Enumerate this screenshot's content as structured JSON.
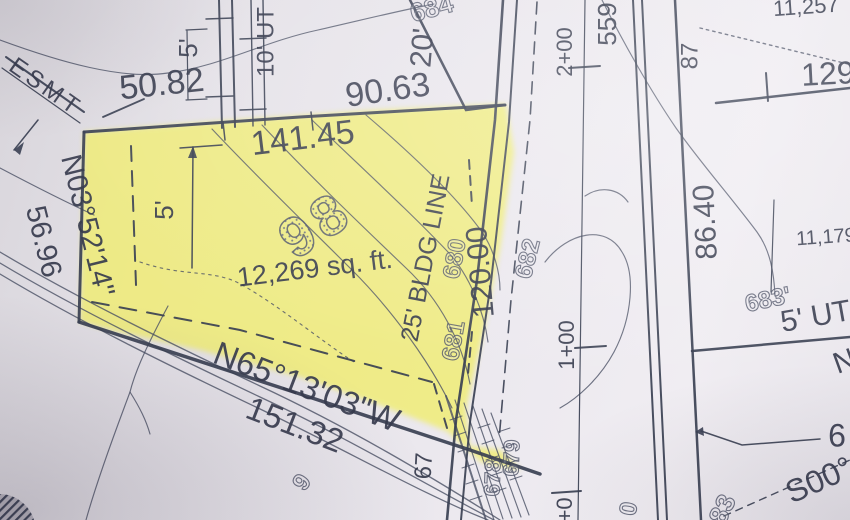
{
  "map": {
    "type": "subdivision-plat-survey-photo",
    "highlighted_lot": {
      "number": "98",
      "area": "12,269 sq. ft."
    },
    "colors": {
      "paper": "#e8e5ea",
      "ink": "#3a4053",
      "highlight": "#f0ed6e"
    },
    "labels": [
      {
        "name": "esmt-label",
        "text": "ESMT",
        "x": 45,
        "y": 88,
        "rot": 35,
        "size": 24,
        "ls": 4
      },
      {
        "name": "dim-50-82",
        "text": "50.82",
        "x": 162,
        "y": 86,
        "rot": -6,
        "size": 34
      },
      {
        "name": "easement-5ft-top",
        "text": "5'",
        "x": 190,
        "y": 48,
        "rot": -90,
        "size": 26
      },
      {
        "name": "easement-10ft-ut",
        "text": "10' UT",
        "x": 267,
        "y": 42,
        "rot": -90,
        "size": 24
      },
      {
        "name": "dim-90-63",
        "text": "90.63",
        "x": 388,
        "y": 92,
        "rot": -8,
        "size": 34
      },
      {
        "name": "easement-20ft",
        "text": "20'",
        "x": 424,
        "y": 48,
        "rot": -85,
        "size": 30
      },
      {
        "name": "contour-684",
        "text": "684",
        "x": 432,
        "y": 10,
        "rot": -15,
        "size": 26,
        "style": "outline"
      },
      {
        "name": "station-2-00",
        "text": "2+00",
        "x": 566,
        "y": 52,
        "rot": -90,
        "size": 22
      },
      {
        "name": "dim-559",
        "text": "559",
        "x": 609,
        "y": 24,
        "rot": -90,
        "size": 26
      },
      {
        "name": "dim-87",
        "text": "87",
        "x": 691,
        "y": 56,
        "rot": -90,
        "size": 24
      },
      {
        "name": "lot-area-11257",
        "text": "11,257",
        "x": 806,
        "y": 8,
        "rot": -4,
        "size": 22
      },
      {
        "name": "dim-129",
        "text": "129",
        "x": 828,
        "y": 76,
        "rot": -3,
        "size": 32
      },
      {
        "name": "dim-86-40",
        "text": "86.40",
        "x": 707,
        "y": 222,
        "rot": -93,
        "size": 30
      },
      {
        "name": "lot-area-11179",
        "text": "11,179",
        "x": 826,
        "y": 238,
        "rot": -4,
        "size": 20
      },
      {
        "name": "contour-683",
        "text": "683'",
        "x": 768,
        "y": 301,
        "rot": -12,
        "size": 24,
        "style": "outline"
      },
      {
        "name": "easement-5ft-ut",
        "text": "5' UT",
        "x": 816,
        "y": 318,
        "rot": -10,
        "size": 30
      },
      {
        "name": "bearing-n03-52-14",
        "text": "N03°52'14\"",
        "x": 86,
        "y": 226,
        "rot": 76,
        "size": 29
      },
      {
        "name": "dim-56-96",
        "text": "56.96",
        "x": 42,
        "y": 242,
        "rot": 76,
        "size": 29
      },
      {
        "name": "dim-141-45",
        "text": "141.45",
        "x": 303,
        "y": 140,
        "rot": -7,
        "size": 34
      },
      {
        "name": "lot-number",
        "text": "98",
        "x": 318,
        "y": 228,
        "rot": -33,
        "size": 56,
        "ls": 6,
        "style": "outline-big"
      },
      {
        "name": "lot-area",
        "text": "12,269 sq. ft.",
        "x": 315,
        "y": 270,
        "rot": -7,
        "size": 27
      },
      {
        "name": "dim-5ft-lot",
        "text": "5'",
        "x": 166,
        "y": 210,
        "rot": -90,
        "size": 26
      },
      {
        "name": "building-line-label",
        "text": "25' BLDG LINE",
        "x": 427,
        "y": 258,
        "rot": -79,
        "size": 25
      },
      {
        "name": "contour-680",
        "text": "680",
        "x": 456,
        "y": 259,
        "rot": -80,
        "size": 24,
        "style": "outline"
      },
      {
        "name": "contour-681",
        "text": "681",
        "x": 455,
        "y": 341,
        "rot": -80,
        "size": 24,
        "style": "outline"
      },
      {
        "name": "contour-682",
        "text": "682",
        "x": 529,
        "y": 259,
        "rot": -76,
        "size": 24,
        "style": "outline"
      },
      {
        "name": "dim-120-00",
        "text": "120.00",
        "x": 482,
        "y": 272,
        "rot": -95,
        "size": 30
      },
      {
        "name": "station-1-00",
        "text": "1+00",
        "x": 568,
        "y": 345,
        "rot": -90,
        "size": 22
      },
      {
        "name": "bearing-n65-13-03",
        "text": "N65°13'03\"W",
        "x": 306,
        "y": 389,
        "rot": 21,
        "size": 33
      },
      {
        "name": "dim-151-32",
        "text": "151.32",
        "x": 294,
        "y": 427,
        "rot": 21,
        "size": 33
      },
      {
        "name": "contour-9",
        "text": "9",
        "x": 303,
        "y": 483,
        "rot": -55,
        "size": 24,
        "style": "outline"
      },
      {
        "name": "contour-67",
        "text": "67",
        "x": 425,
        "y": 466,
        "rot": -87,
        "size": 24
      },
      {
        "name": "contour-678",
        "text": "678",
        "x": 494,
        "y": 478,
        "rot": -88,
        "size": 22,
        "style": "outline"
      },
      {
        "name": "contour-679",
        "text": "679",
        "x": 513,
        "y": 458,
        "rot": -88,
        "size": 22,
        "style": "outline"
      },
      {
        "name": "station-0-00",
        "text": "0+0",
        "x": 566,
        "y": 516,
        "rot": -90,
        "size": 22
      },
      {
        "name": "contour-mark-0",
        "text": "0",
        "x": 630,
        "y": 509,
        "rot": -80,
        "size": 24,
        "style": "outline"
      },
      {
        "name": "contour-mark-83",
        "text": "83",
        "x": 724,
        "y": 510,
        "rot": -65,
        "size": 26,
        "style": "outline"
      },
      {
        "name": "elev-6-partial",
        "text": "6",
        "x": 837,
        "y": 438,
        "rot": 0,
        "size": 32
      },
      {
        "name": "bearing-s00-partial",
        "text": "S00°",
        "x": 820,
        "y": 482,
        "rot": -24,
        "size": 32
      },
      {
        "name": "bearing-n-partial",
        "text": "N",
        "x": 845,
        "y": 363,
        "rot": -20,
        "size": 30
      }
    ]
  }
}
